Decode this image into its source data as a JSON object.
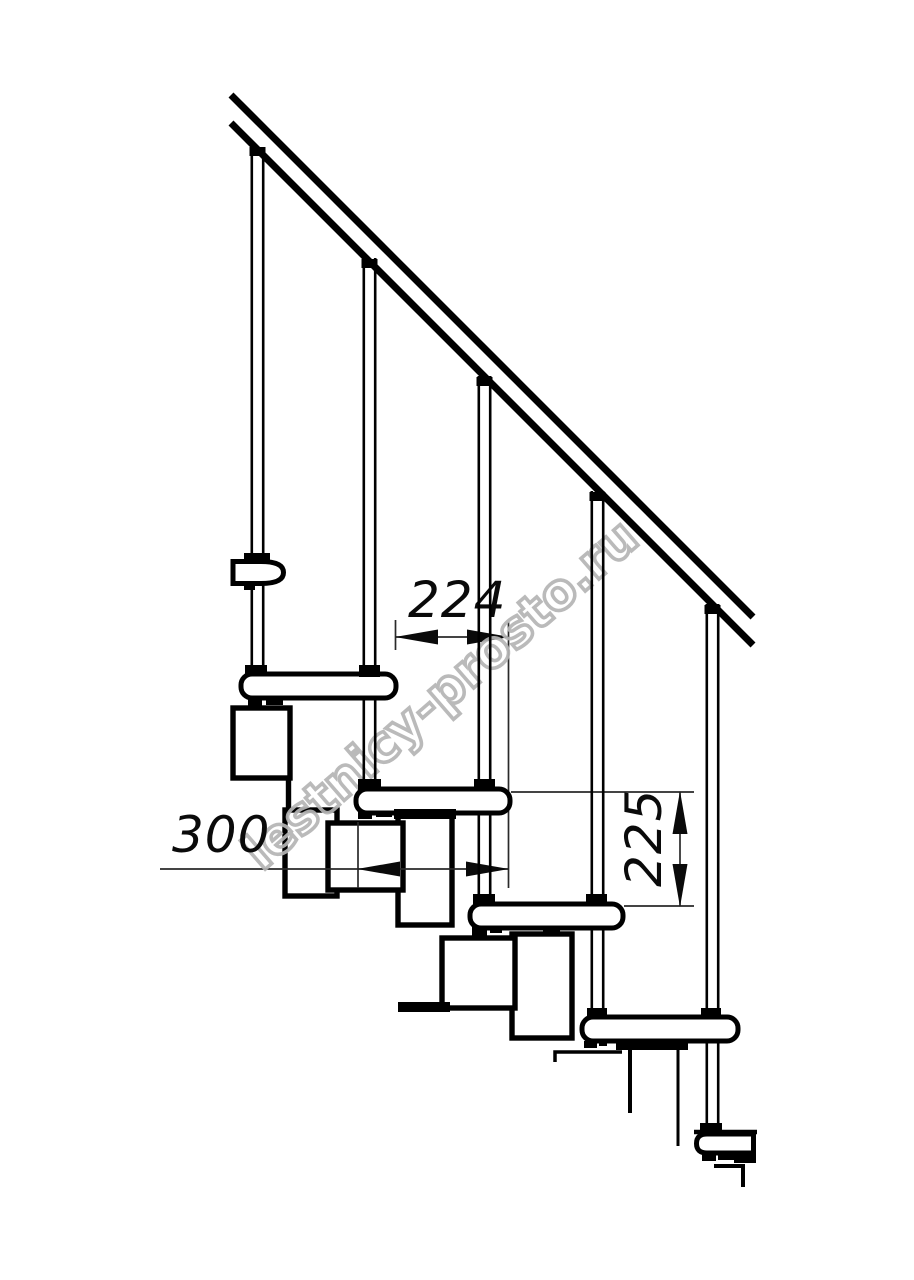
{
  "page": {
    "background": "#ffffff"
  },
  "drawing": {
    "title": "Modular staircase side-view technical drawing",
    "dimensions": {
      "run": {
        "value": "224"
      },
      "depth": {
        "value": "300"
      },
      "rise": {
        "value": "225"
      }
    },
    "watermark": {
      "text": "lestnicy-prosto.ru",
      "color": "#b5b5b5"
    },
    "line_color": "#000000"
  }
}
